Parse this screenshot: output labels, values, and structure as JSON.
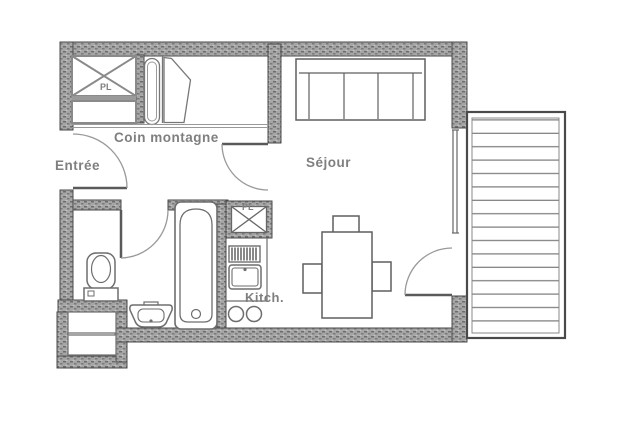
{
  "labels": {
    "entree": "Entrée",
    "coin_montagne": "Coin montagne",
    "sejour": "Séjour",
    "kitchen": "Kitch.",
    "closet_top": "PL",
    "closet_kitchen": "PL"
  },
  "colors": {
    "background": "#ffffff",
    "wall_fill": "#a6a6a6",
    "wall_speckle": "#6d6d6d",
    "outline": "#4a4a4a",
    "furniture_line": "#6e6e6e",
    "label_text": "#7f7f7f"
  }
}
